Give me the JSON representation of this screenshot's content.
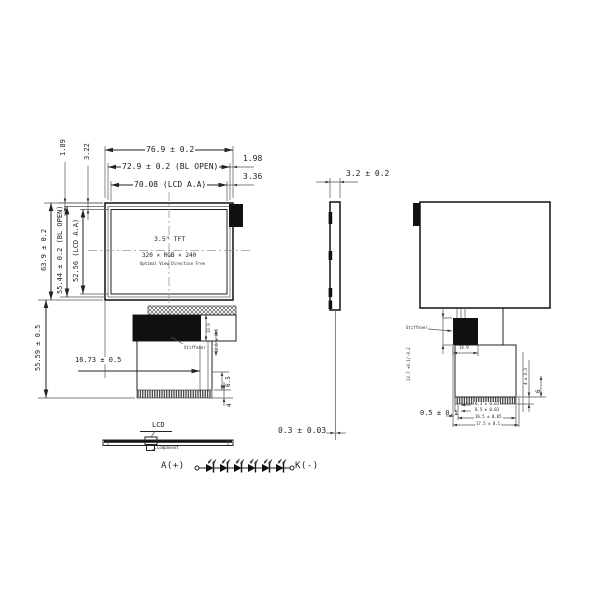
{
  "front_view": {
    "size_label": "3.5\" TFT",
    "resolution": "320 × RGB × 240",
    "view_direction": "Optimal View Direction Free"
  },
  "dimensions": {
    "overall_width": "76.9 ± 0.2",
    "bl_open_width": "72.9 ± 0.2 (BL OPEN)",
    "lcd_aa_width": "70.08 (LCD A.A)",
    "gap_right_bl": "1.98",
    "gap_right_aa": "3.36",
    "gap_left_bl": "1.89",
    "gap_left_aa": "3.22",
    "overall_height": "63.9 ± 0.2",
    "bl_open_height": "55.44 ± 0.2 (BL OPEN)",
    "lcd_aa_height": "52.56 (LCD A.A)",
    "module_total_height": "55.59 ± 0.5",
    "fpc_offset": "16.73 ± 0.5",
    "fpc_stiffener_height": "6.5",
    "fpc_contact_height": "4",
    "connector_dim_a": "10.9",
    "connector_dim_b": "12.6 ± 0.5",
    "thickness": "3.2 ± 0.2",
    "fpc_thickness": "0.3 ± 0.03",
    "back_connector_height": "13.7 +0.1/-0.2",
    "back_connector_width": "14.9",
    "fpc_end_dim_1": "0.3 ± 0.03",
    "fpc_end_dim_2": "0.5 ± 0.03",
    "fpc_end_dim_3": "16.5 ± 0.05",
    "fpc_end_dim_4": "17.5 ± 0.1",
    "fpc_end_offset": "0.5 ± 0.1",
    "back_right_dim_a": "4 ± 0.3",
    "back_right_dim_b": "6"
  },
  "labels": {
    "lcd": "LCD",
    "stiffener_front": "Stiffener",
    "stiffener_back": "Stiffener",
    "component": "Component"
  },
  "led_circuit": {
    "anode": "A(+)",
    "cathode": "K(-)",
    "led_count": 6
  }
}
